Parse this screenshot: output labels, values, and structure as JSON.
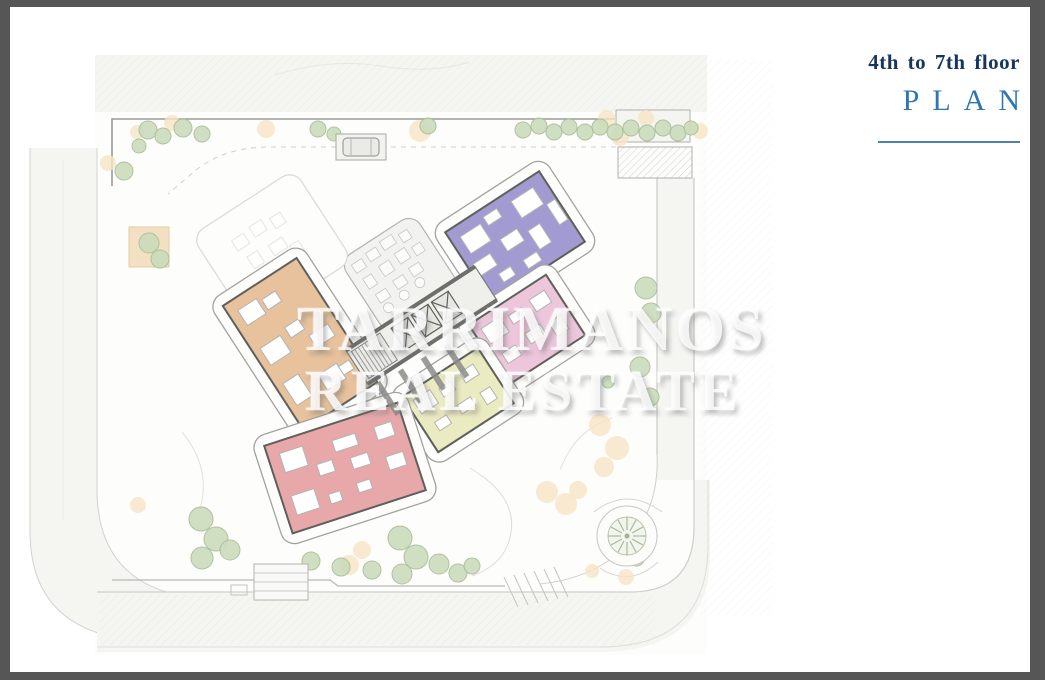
{
  "header": {
    "floor_range": "4th to 7th floor",
    "plan": "PLAN"
  },
  "watermark": {
    "line1": "TARRIMANOS",
    "line2": "REAL ESTATE"
  },
  "frame": {
    "color": "#565656"
  },
  "title_colors": {
    "floor": "#17365d",
    "plan": "#2e75b6",
    "divider": "#517fae"
  },
  "plan": {
    "colors": {
      "paper": "#fdfdfb",
      "road_fill": "#f5f5f2",
      "road_edge": "#cfcfcc",
      "boundary": "#9b9b98",
      "orange": "#e7c29c",
      "purple": "#a19bd1",
      "pink": "#eec6db",
      "yellow": "#ebebc2",
      "red": "#e8a8aa",
      "wall": "#5f5f5c",
      "envelope_fill": "#fdfdfc",
      "envelope_stroke": "#a2a29f",
      "ghost_stroke": "#dbdbd7",
      "furniture_fill": "#ffffff",
      "furniture_stroke": "#b3b3b0",
      "core_fill": "#efefec",
      "core_wall": "#6e6e6b",
      "tree_fill": "#ccdcbc",
      "tree_stroke": "#a7bd96",
      "shrub_fill": "#f6e3c5",
      "palm_green": "#a9bb9c"
    },
    "units": [
      {
        "name": "ghost-unit",
        "ghost": true,
        "cx": 272,
        "cy": 248,
        "w": 100,
        "h": 86,
        "angle": -33,
        "furniture": [
          [
            -30,
            -28,
            14,
            12
          ],
          [
            -8,
            -30,
            14,
            12
          ],
          [
            14,
            -26,
            12,
            12
          ],
          [
            -26,
            -6,
            12,
            14
          ],
          [
            -2,
            -4,
            16,
            12
          ],
          [
            -30,
            14,
            12,
            10
          ],
          [
            -6,
            16,
            14,
            10
          ],
          [
            16,
            8,
            10,
            12
          ]
        ]
      },
      {
        "name": "apartment-orange",
        "color": "orange",
        "cx": 300,
        "cy": 344,
        "w": 88,
        "h": 148,
        "angle": -33,
        "furniture": [
          [
            -34,
            -62,
            22,
            18
          ],
          [
            -8,
            -58,
            16,
            12
          ],
          [
            -36,
            -18,
            24,
            20
          ],
          [
            -4,
            -22,
            16,
            12
          ],
          [
            12,
            -2,
            22,
            14
          ],
          [
            -36,
            24,
            18,
            26
          ],
          [
            -2,
            36,
            22,
            18
          ],
          [
            20,
            40,
            12,
            10
          ]
        ]
      },
      {
        "name": "apartment-purple",
        "color": "purple",
        "cx": 515,
        "cy": 237,
        "w": 112,
        "h": 84,
        "angle": -33,
        "furniture": [
          [
            -46,
            -30,
            24,
            20
          ],
          [
            -16,
            -34,
            16,
            10
          ],
          [
            16,
            -32,
            26,
            20
          ],
          [
            44,
            -10,
            10,
            24
          ],
          [
            -50,
            0,
            20,
            14
          ],
          [
            -14,
            -6,
            20,
            14
          ],
          [
            14,
            2,
            14,
            22
          ],
          [
            -34,
            22,
            14,
            10
          ],
          [
            -6,
            24,
            16,
            10
          ]
        ]
      },
      {
        "name": "apartment-pink",
        "color": "pink",
        "cx": 527,
        "cy": 330,
        "w": 92,
        "h": 72,
        "angle": -33,
        "furniture": [
          [
            -38,
            -26,
            22,
            18
          ],
          [
            -8,
            -22,
            16,
            10
          ],
          [
            18,
            -24,
            18,
            14
          ],
          [
            -34,
            6,
            16,
            12
          ],
          [
            -4,
            2,
            18,
            12
          ],
          [
            22,
            6,
            14,
            16
          ]
        ]
      },
      {
        "name": "apartment-yellow",
        "color": "yellow",
        "cx": 458,
        "cy": 400,
        "w": 90,
        "h": 66,
        "angle": -33,
        "furniture": [
          [
            -38,
            -24,
            20,
            16
          ],
          [
            -10,
            -20,
            14,
            10
          ],
          [
            16,
            -22,
            16,
            12
          ],
          [
            -32,
            6,
            14,
            10
          ],
          [
            -4,
            4,
            16,
            10
          ],
          [
            22,
            6,
            12,
            14
          ]
        ]
      },
      {
        "name": "apartment-red",
        "color": "red",
        "cx": 345,
        "cy": 468,
        "w": 140,
        "h": 92,
        "angle": -18,
        "furniture": [
          [
            -58,
            -34,
            24,
            20
          ],
          [
            -60,
            10,
            24,
            20
          ],
          [
            -26,
            -12,
            16,
            12
          ],
          [
            -4,
            -30,
            24,
            12
          ],
          [
            8,
            -8,
            18,
            12
          ],
          [
            40,
            -30,
            18,
            14
          ],
          [
            42,
            2,
            18,
            14
          ],
          [
            6,
            18,
            14,
            10
          ],
          [
            -24,
            20,
            12,
            10
          ]
        ]
      }
    ],
    "landscape": {
      "trees": [
        [
          148,
          130,
          9
        ],
        [
          163,
          136,
          8
        ],
        [
          183,
          128,
          9
        ],
        [
          202,
          134,
          8
        ],
        [
          139,
          146,
          7
        ],
        [
          318,
          129,
          8
        ],
        [
          334,
          134,
          7
        ],
        [
          428,
          126,
          8
        ],
        [
          523,
          130,
          8
        ],
        [
          539,
          126,
          8
        ],
        [
          554,
          132,
          8
        ],
        [
          569,
          127,
          8
        ],
        [
          585,
          132,
          8
        ],
        [
          600,
          127,
          8
        ],
        [
          615,
          132,
          8
        ],
        [
          631,
          128,
          8
        ],
        [
          647,
          133,
          8
        ],
        [
          663,
          128,
          8
        ],
        [
          678,
          133,
          8
        ],
        [
          691,
          128,
          7
        ],
        [
          124,
          171,
          9
        ],
        [
          149,
          243,
          10
        ],
        [
          160,
          259,
          9
        ],
        [
          646,
          288,
          11
        ],
        [
          651,
          313,
          10
        ],
        [
          640,
          367,
          10
        ],
        [
          650,
          397,
          9
        ],
        [
          201,
          519,
          12
        ],
        [
          216,
          539,
          12
        ],
        [
          202,
          558,
          11
        ],
        [
          230,
          550,
          10
        ],
        [
          311,
          561,
          9
        ],
        [
          341,
          567,
          9
        ],
        [
          372,
          570,
          9
        ],
        [
          400,
          538,
          12
        ],
        [
          416,
          557,
          12
        ],
        [
          402,
          574,
          10
        ],
        [
          439,
          564,
          10
        ],
        [
          458,
          573,
          9
        ],
        [
          472,
          566,
          8
        ],
        [
          637,
          559,
          7
        ],
        [
          608,
          382,
          6
        ]
      ],
      "shrubs": [
        [
          172,
          123,
          8
        ],
        [
          266,
          129,
          9
        ],
        [
          137,
          132,
          7
        ],
        [
          108,
          163,
          8
        ],
        [
          420,
          131,
          11
        ],
        [
          607,
          119,
          9
        ],
        [
          646,
          118,
          8
        ],
        [
          700,
          131,
          8
        ],
        [
          620,
          137,
          9
        ],
        [
          600,
          425,
          11
        ],
        [
          617,
          448,
          12
        ],
        [
          604,
          467,
          10
        ],
        [
          547,
          492,
          11
        ],
        [
          566,
          504,
          11
        ],
        [
          578,
          490,
          9
        ],
        [
          349,
          565,
          10
        ],
        [
          362,
          550,
          9
        ],
        [
          626,
          577,
          8
        ],
        [
          592,
          571,
          7
        ],
        [
          138,
          505,
          8
        ]
      ]
    }
  }
}
